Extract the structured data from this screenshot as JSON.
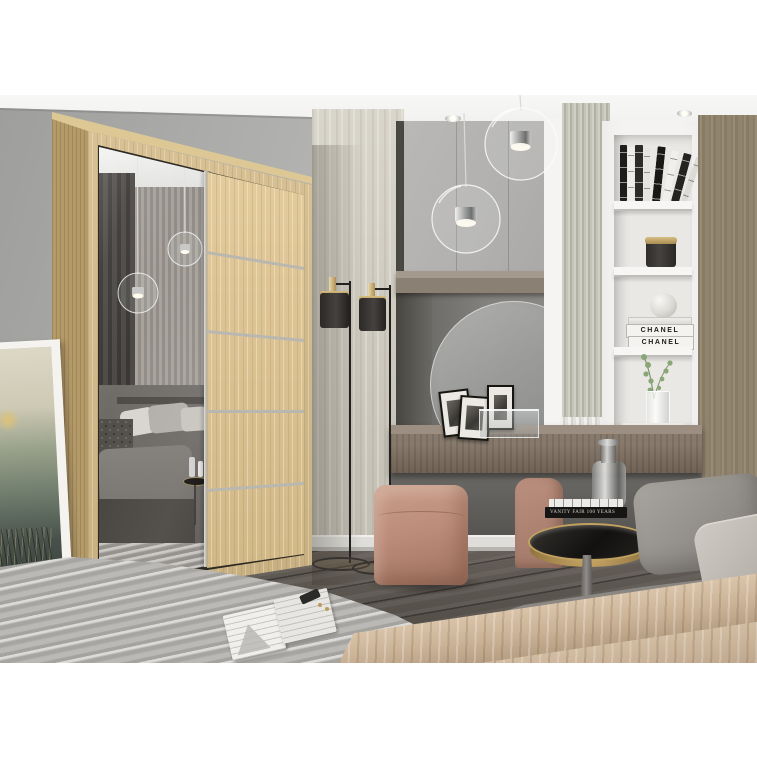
{
  "image": {
    "kind": "furniture product photo (3D render)",
    "subject": "Sonoma-oak sliding-door wardrobe with mirror door in a modern grey bedroom",
    "background": "white frame margins top and bottom"
  },
  "visible_text": {
    "chanel_books": [
      "CHANEL",
      "CHANEL"
    ],
    "side_table_book_spine": "VANITY FAIR 100 YEARS"
  },
  "palette": {
    "margin_white": "#ffffff",
    "wall_grey": "#b4b4b2",
    "ceiling_white": "#f2f2f0",
    "wardrobe_oak": "#d3ba89",
    "wardrobe_side_oak": "#b49a69",
    "aluminium_strip": "#b9b8b0",
    "mirror_grey": "#8f8c88",
    "floor_wood_dark": "#5a544e",
    "rug_grey": "#b4b2ae",
    "pouf_blush": "#bb8d7a",
    "throw_beige": "#c9b195",
    "bed_linen_grey": "#9a9691",
    "brass_accent": "#c2a25f",
    "shelving_white": "#f4f3f1",
    "right_wood_panel": "#93866f",
    "fluted_sage": "#c4c4b8",
    "lamp_black": "#2b2926"
  },
  "objects": [
    "sliding-door wardrobe with mirror",
    "framed art print leaning on wall",
    "two glass globe pendant lights",
    "double black floor lamp with brass caps",
    "grey wall cabinets",
    "round vanity mirror",
    "floating wood console with photo frames",
    "blush cube pouf",
    "white open shelving with books, candle, CHANEL books, eucalyptus",
    "brass side table with black glass top, books and smoked-glass vase",
    "bed with grey linen, grey pillows and beige throw",
    "grey shaggy rug with open magazine and keys",
    "dark wood plank floor",
    "white ribbed radiator",
    "sage fluted wall panel",
    "taupe wood wardrobe panel"
  ]
}
